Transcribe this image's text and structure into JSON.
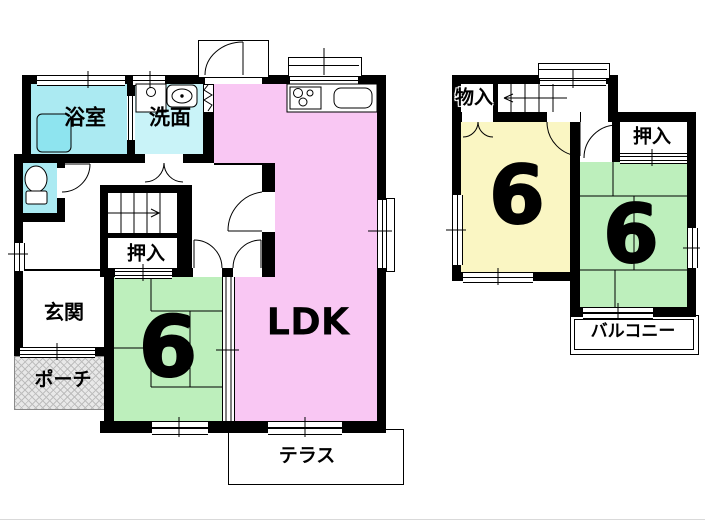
{
  "floor1": {
    "bathroom_label": "浴室",
    "washroom_label": "洗面",
    "ldk_label": "LDK",
    "tatami_room_size": "6",
    "closet_label": "押入",
    "entrance_label": "玄関",
    "porch_label": "ポーチ",
    "terrace_label": "テラス"
  },
  "floor2": {
    "storage_label": "物入",
    "closet_label": "押入",
    "west_room_size": "6",
    "east_room_size": "6",
    "balcony_label": "バルコニー"
  },
  "colors": {
    "ldk_pink": "#F9C7F3",
    "tatami_green": "#BDEFBC",
    "western_room_yellow": "#FAF6C3",
    "bathroom_cyan": "#ABEAF2",
    "washroom_cyan": "#C9F3F8",
    "bathtub_cyan": "#8EE4EF",
    "counter_brown": "#A48A5F",
    "porch_gray": "#E8E8E8",
    "wall_black": "#000000"
  }
}
